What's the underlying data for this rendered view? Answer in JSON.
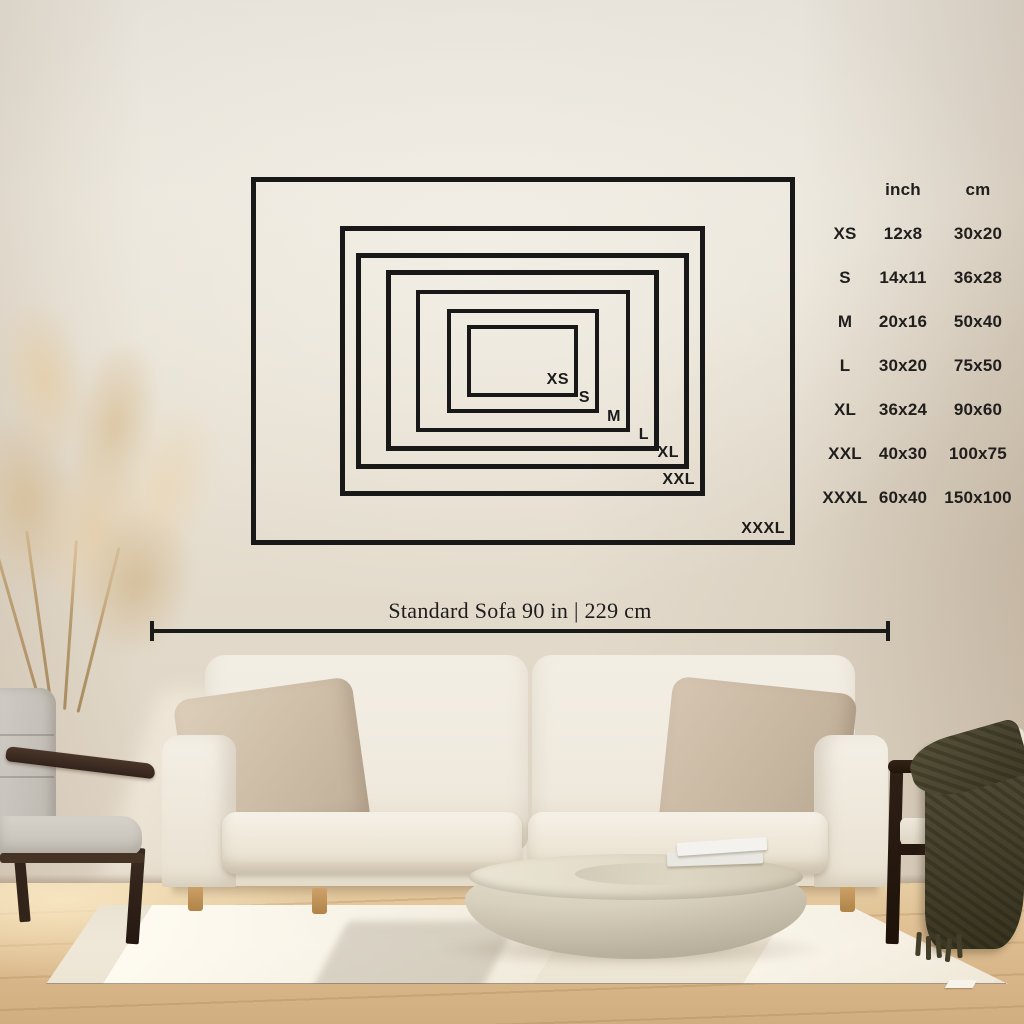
{
  "sofa_scale": {
    "label": "Standard Sofa 90 in | 229 cm"
  },
  "size_table": {
    "col_headers": {
      "inch": "inch",
      "cm": "cm"
    },
    "rows": [
      {
        "size": "XS",
        "inch": "12x8",
        "cm": "30x20"
      },
      {
        "size": "S",
        "inch": "14x11",
        "cm": "36x28"
      },
      {
        "size": "M",
        "inch": "20x16",
        "cm": "50x40"
      },
      {
        "size": "L",
        "inch": "30x20",
        "cm": "75x50"
      },
      {
        "size": "XL",
        "inch": "36x24",
        "cm": "90x60"
      },
      {
        "size": "XXL",
        "inch": "40x30",
        "cm": "100x75"
      },
      {
        "size": "XXXL",
        "inch": "60x40",
        "cm": "150x100"
      }
    ]
  },
  "colors": {
    "overlay_black": "#1a1a1a",
    "wall": "#e6dfd2",
    "floor_wood": "#d9b88a",
    "rug": "#ece5d5",
    "sofa": "#f0ebe0",
    "pillow_taupe": "#cfc0ab",
    "chair_cushion_gray": "#c9c5be",
    "wood_dark": "#3a2a20",
    "blanket_olive": "#45402c",
    "coffee_table_stone": "#d6cfbc",
    "pampas_plant": "#dcc5a2"
  }
}
